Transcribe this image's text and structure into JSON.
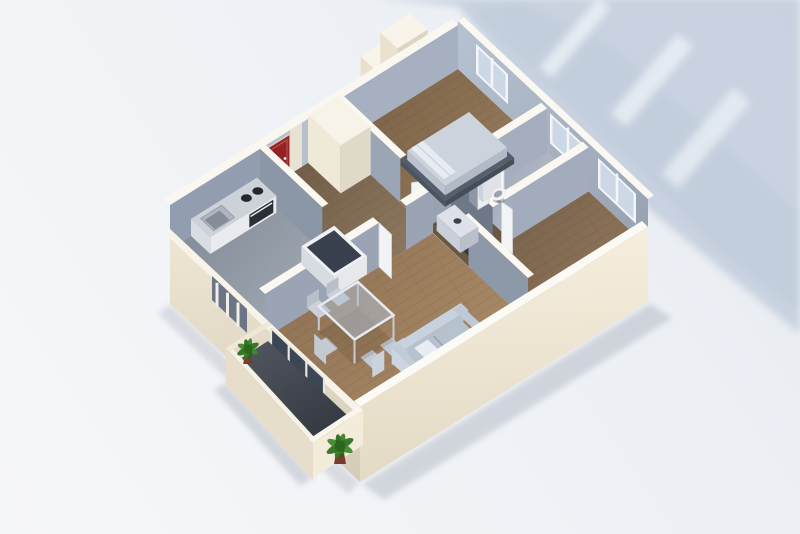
{
  "figure": {
    "alt": "3D isometric rendering of an apartment floor plan with cream exterior walls, blue-grey interior walls, wood floors, a red entrance door, kitchen, bathroom, two bedrooms, living room with sofa and glass dining table, and a balcony with two green plants, casting a soft blue shadow toward the upper right"
  },
  "palette": {
    "bg": "#edf0f5",
    "bg_light": "#f6f7f9",
    "shadow_blue": "#c5cfde",
    "shadow_streak": "#eef3f8",
    "wall_top": "#fbf8f1",
    "wall_cream_front": "#f2ebdb",
    "wall_cream_side": "#e2d9c5",
    "wall_interior_shaded": "#99a4b5",
    "wall_interior_light": "#b7c0cf",
    "door_red": "#8e1f1f",
    "wood_living": "#a08059",
    "wood_bedroom": "#8a6f50",
    "wood_hall": "#816c55",
    "floor_kitchen": "#97a0ac",
    "floor_bathroom": "#aeb7c3",
    "floor_balcony": "#41454e",
    "floor_niche": "#343944",
    "sofa_grey": "#b7c2cf",
    "table_glass": "#b0bed2",
    "fixture_white": "#eef0f4",
    "appliance_dark": "#2b3037",
    "plant_green": "#33781f",
    "plant_pot": "#7c3c2c"
  },
  "scene": {
    "view": "isometric top-down, building oriented diagonally, shadow cast to upper right",
    "shadow_streak_count": 3,
    "rooms": [
      {
        "id": "kitchen",
        "floor": "grey tile",
        "furniture": [
          "counter with sink",
          "cooktop with two burners",
          "oven",
          "island cabinet with dark top"
        ]
      },
      {
        "id": "entrance-hall",
        "floor": "wood",
        "furniture": [
          "red entrance door",
          "tall white wardrobe"
        ]
      },
      {
        "id": "bedroom-1",
        "floor": "wood",
        "furniture": [
          "double bed with white pillows",
          "window"
        ]
      },
      {
        "id": "corridor",
        "floor": "wood",
        "furniture": [
          "dark utility niche",
          "washing machine"
        ]
      },
      {
        "id": "bathroom",
        "floor": "grey tile",
        "furniture": [
          "toilet",
          "window"
        ]
      },
      {
        "id": "bedroom-2",
        "floor": "wood",
        "furniture": [
          "radiator",
          "window"
        ]
      },
      {
        "id": "living-room",
        "floor": "wood",
        "furniture": [
          "grey three-seat sofa",
          "glass dining table",
          "5 chairs",
          "white interior doors"
        ]
      },
      {
        "id": "balcony",
        "floor": "dark grey",
        "furniture": [
          "potted plant",
          "potted plant",
          "sliding glass doors"
        ]
      }
    ]
  }
}
